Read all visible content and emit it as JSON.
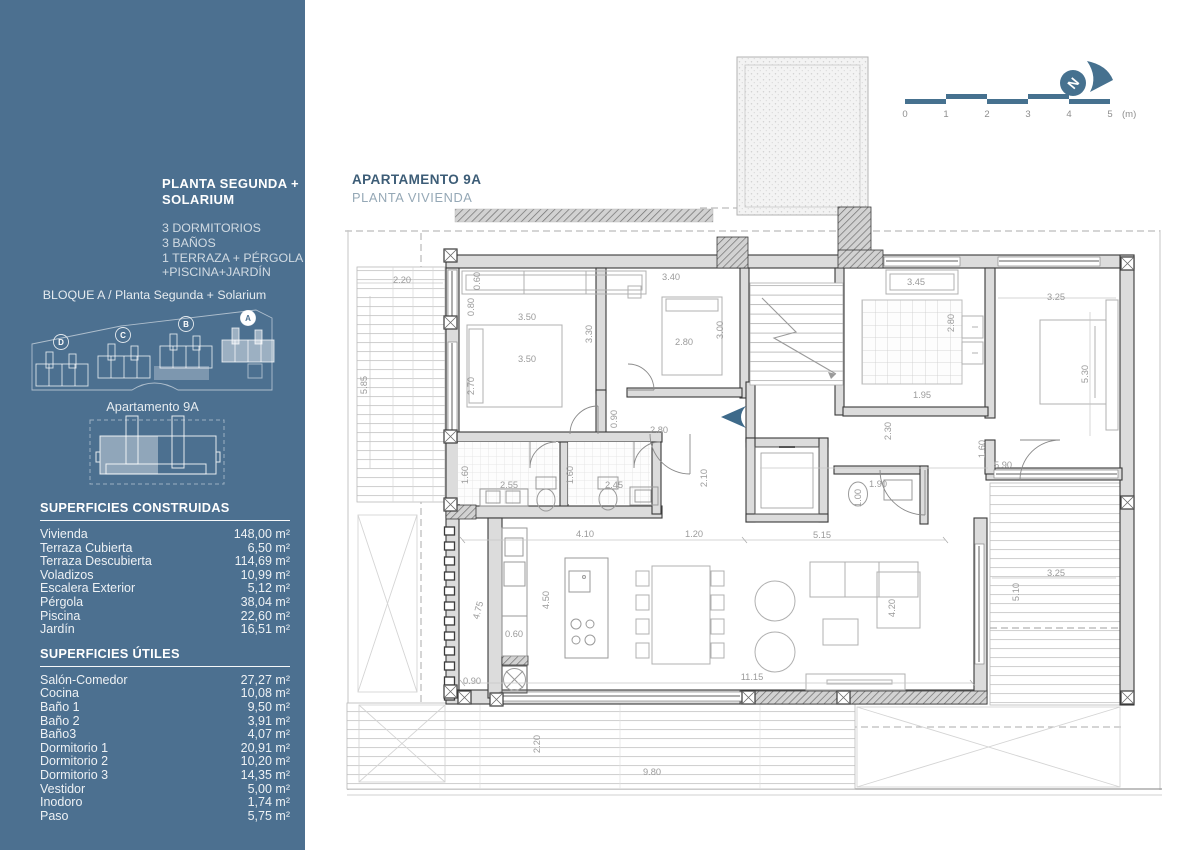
{
  "sidebar": {
    "title_lines": [
      "PLANTA SEGUNDA +",
      "SOLARIUM"
    ],
    "features": [
      "3 DORMITORIOS",
      "3 BAÑOS",
      "1 TERRAZA + PÉRGOLA",
      "+PISCINA+JARDÍN"
    ],
    "block_label": "BLOQUE A / Planta Segunda + Solarium",
    "site_blocks": [
      "D",
      "C",
      "B",
      "A"
    ],
    "highlighted_block": "A",
    "apartment_label": "Apartamento 9A",
    "tables": [
      {
        "heading": "SUPERFICIES CONSTRUIDAS",
        "rows": [
          [
            "Vivienda",
            "148,00 m²"
          ],
          [
            "Terraza Cubierta",
            "6,50 m²"
          ],
          [
            "Terraza Descubierta",
            "114,69 m²"
          ],
          [
            "Voladizos",
            "10,99 m²"
          ],
          [
            "Escalera Exterior",
            "5,12 m²"
          ],
          [
            "Pérgola",
            "38,04 m²"
          ],
          [
            "Piscina",
            "22,60 m²"
          ],
          [
            "Jardín",
            "16,51 m²"
          ]
        ]
      },
      {
        "heading": "SUPERFICIES ÚTILES",
        "rows": [
          [
            "Salón-Comedor",
            "27,27 m²"
          ],
          [
            "Cocina",
            "10,08 m²"
          ],
          [
            "Baño 1",
            "9,50 m²"
          ],
          [
            "Baño 2",
            "3,91 m²"
          ],
          [
            "Baño3",
            "4,07 m²"
          ],
          [
            "Dormitorio 1",
            "20,91 m²"
          ],
          [
            "Dormitorio 2",
            "10,20 m²"
          ],
          [
            "Dormitorio 3",
            "14,35 m²"
          ],
          [
            "Vestidor",
            "5,00 m²"
          ],
          [
            "Inodoro",
            "1,74 m²"
          ],
          [
            "Paso",
            "5,75 m²"
          ]
        ]
      }
    ]
  },
  "plan": {
    "title": "APARTAMENTO 9A",
    "subtitle": "PLANTA VIVIENDA",
    "compass_letter": "N",
    "scale_bar": {
      "tick_labels": [
        "0",
        "1",
        "2",
        "3",
        "4",
        "5"
      ],
      "unit_label": "(m)"
    },
    "dimensions": [
      {
        "t": "2.20",
        "x": 402,
        "y": 283,
        "r": 0
      },
      {
        "t": "5.85",
        "x": 367,
        "y": 385,
        "r": -90
      },
      {
        "t": "0.60",
        "x": 480,
        "y": 281,
        "r": -90
      },
      {
        "t": "0.80",
        "x": 474,
        "y": 307,
        "r": -90
      },
      {
        "t": "3.50",
        "x": 527,
        "y": 320,
        "r": 0
      },
      {
        "t": "3.50",
        "x": 527,
        "y": 362,
        "r": 0
      },
      {
        "t": "2.70",
        "x": 474,
        "y": 386,
        "r": -90
      },
      {
        "t": "3.30",
        "x": 592,
        "y": 334,
        "r": -90
      },
      {
        "t": "3.40",
        "x": 671,
        "y": 280,
        "r": 0
      },
      {
        "t": "2.80",
        "x": 684,
        "y": 345,
        "r": 0
      },
      {
        "t": "3.00",
        "x": 723,
        "y": 330,
        "r": -90
      },
      {
        "t": "0.90",
        "x": 617,
        "y": 419,
        "r": -90
      },
      {
        "t": "2.80",
        "x": 659,
        "y": 433,
        "r": 0
      },
      {
        "t": "1.60",
        "x": 468,
        "y": 475,
        "r": -90
      },
      {
        "t": "2.55",
        "x": 509,
        "y": 488,
        "r": 0
      },
      {
        "t": "1.60",
        "x": 573,
        "y": 475,
        "r": -90
      },
      {
        "t": "2.45",
        "x": 614,
        "y": 488,
        "r": 0
      },
      {
        "t": "2.10",
        "x": 707,
        "y": 478,
        "r": -90
      },
      {
        "t": "3.45",
        "x": 916,
        "y": 285,
        "r": 0
      },
      {
        "t": "2.80",
        "x": 954,
        "y": 323,
        "r": -90
      },
      {
        "t": "1.95",
        "x": 922,
        "y": 398,
        "r": 0
      },
      {
        "t": "2.30",
        "x": 891,
        "y": 431,
        "r": -90
      },
      {
        "t": "3.25",
        "x": 1056,
        "y": 300,
        "r": 0
      },
      {
        "t": "5.30",
        "x": 1088,
        "y": 374,
        "r": -90
      },
      {
        "t": "1.60",
        "x": 985,
        "y": 449,
        "r": -90
      },
      {
        "t": "5.90",
        "x": 1003,
        "y": 468,
        "r": 0
      },
      {
        "t": "1.90",
        "x": 878,
        "y": 487,
        "r": 0
      },
      {
        "t": "1.00",
        "x": 861,
        "y": 498,
        "r": -90
      },
      {
        "t": "5.15",
        "x": 822,
        "y": 538,
        "r": 0
      },
      {
        "t": "4.10",
        "x": 585,
        "y": 537,
        "r": 0
      },
      {
        "t": "1.20",
        "x": 694,
        "y": 537,
        "r": 0
      },
      {
        "t": "4.50",
        "x": 549,
        "y": 600,
        "r": -90
      },
      {
        "t": "4.75",
        "x": 481,
        "y": 611,
        "r": -75
      },
      {
        "t": "0.60",
        "x": 514,
        "y": 637,
        "r": 0
      },
      {
        "t": "0.90",
        "x": 472,
        "y": 684,
        "r": 0
      },
      {
        "t": "11.15",
        "x": 752,
        "y": 680,
        "r": 0
      },
      {
        "t": "4.20",
        "x": 895,
        "y": 608,
        "r": -90
      },
      {
        "t": "3.25",
        "x": 1056,
        "y": 576,
        "r": 0
      },
      {
        "t": "5.10",
        "x": 1019,
        "y": 592,
        "r": -90
      },
      {
        "t": "2.20",
        "x": 540,
        "y": 744,
        "r": -90
      },
      {
        "t": "9.80",
        "x": 652,
        "y": 775,
        "r": 0
      }
    ]
  },
  "colors": {
    "sidebar_bg": "#4c7090",
    "accent_blue": "#46718f",
    "plan_title_text": "#3d5d77",
    "plan_subtitle_text": "#95a8b6",
    "dimension_text": "#9b9b9b",
    "wall_fill": "#dcdcdc",
    "wall_line": "#3a3a3a"
  }
}
